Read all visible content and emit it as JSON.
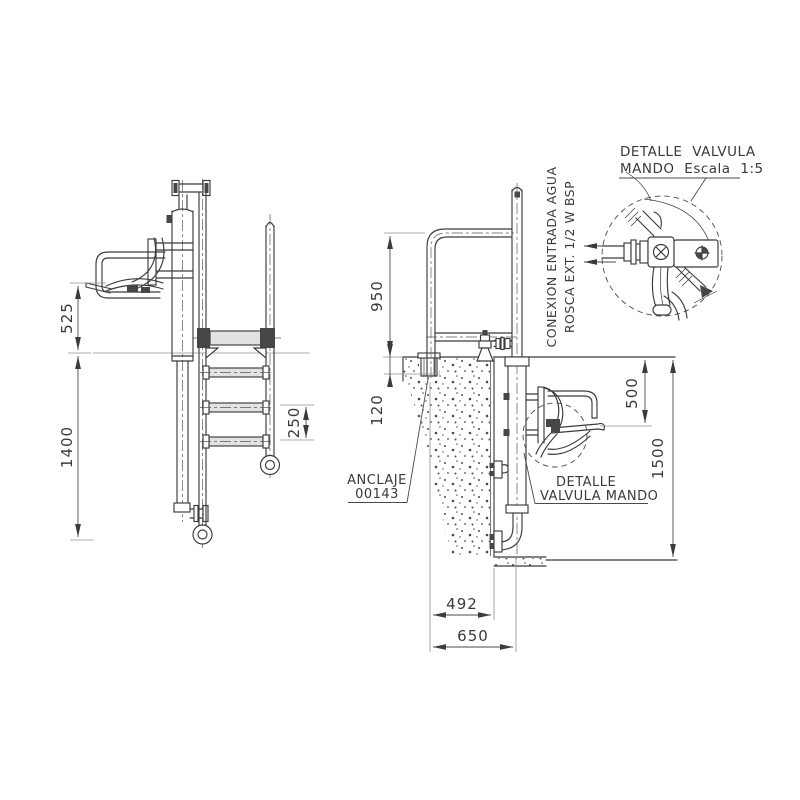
{
  "drawing": {
    "type": "technical-cad-drawing",
    "labels": {
      "detail_title_1": "DETALLE VALVULA",
      "detail_title_2": "MANDO  Escala 1:5",
      "water_conn_1": "CONEXION ENTRADA AGUA",
      "water_conn_2": "ROSCA EXT. 1/2 W BSP",
      "anchor_1": "ANCLAJE",
      "anchor_2": "00143",
      "valve_detail_1": "DETALLE",
      "valve_detail_2": "VALVULA MANDO"
    },
    "dimensions": {
      "seat_above_water": "525",
      "front_depth": "1400",
      "rung_spacing": "250",
      "handrail_height": "950",
      "anchor_depth": "120",
      "seat_below_water": "500",
      "pool_depth": "1500",
      "post_to_wall": "492",
      "post_to_column": "650"
    },
    "colors": {
      "line": "#3b3b3b",
      "light": "#8f8f8f",
      "background": "#ffffff"
    }
  }
}
